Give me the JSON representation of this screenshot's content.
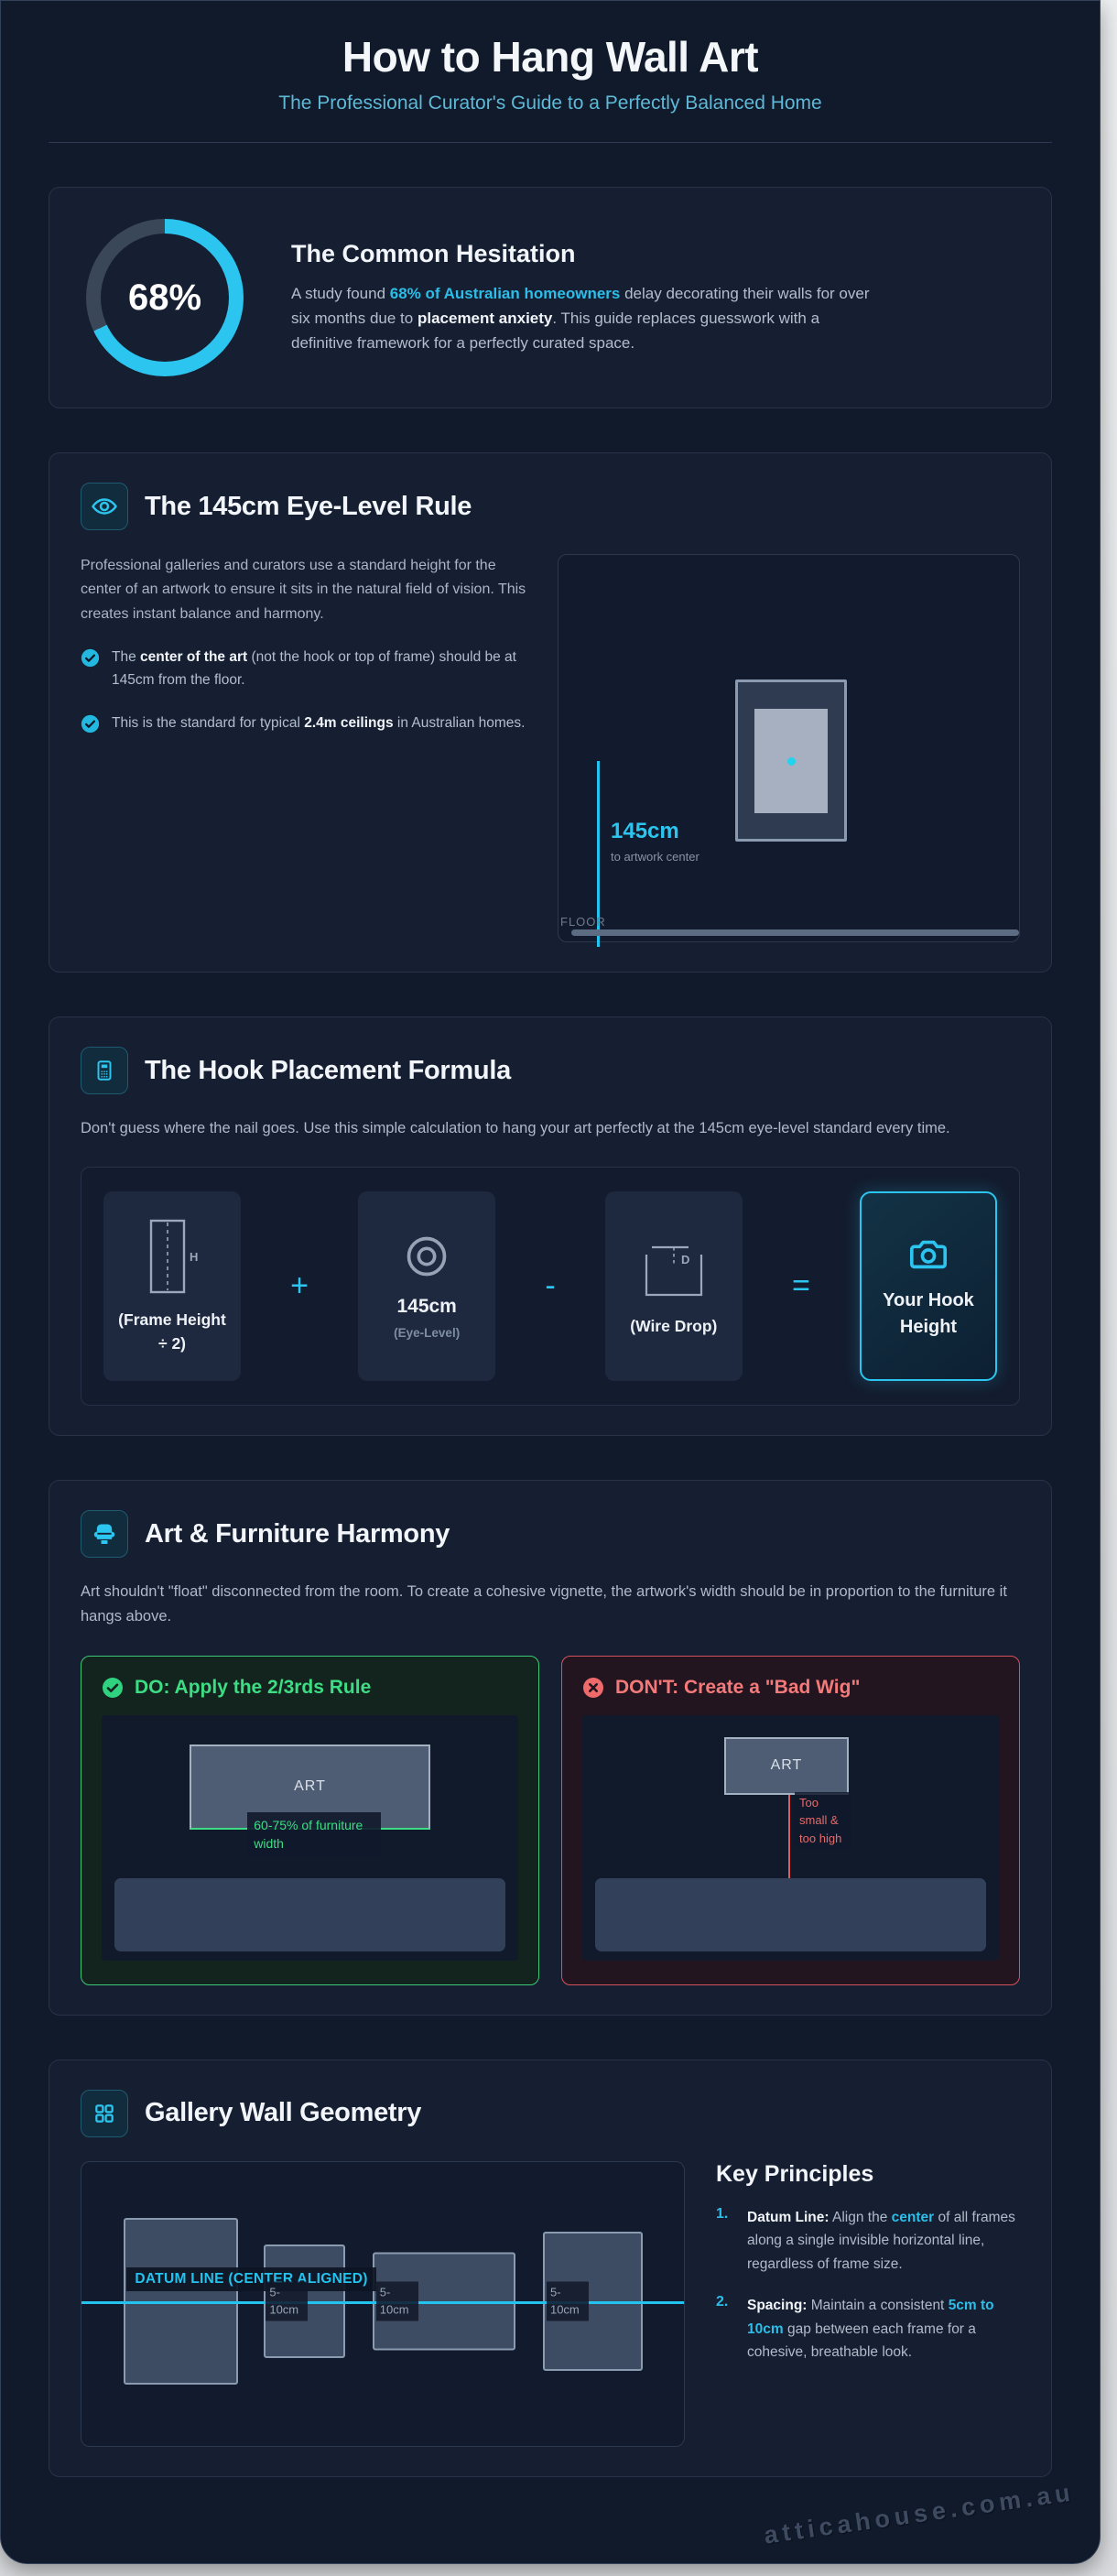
{
  "page": {
    "title": "How to Hang Wall Art",
    "subtitle": "The Professional Curator's Guide to a Perfectly Balanced Home",
    "watermark": "atticahouse.com.au"
  },
  "colors": {
    "accent_cyan": "#2cc5ef",
    "success_green": "#3ddd84",
    "danger_red": "#f47a7a",
    "page_bg": "#101a2b",
    "card_bg": "#161f31"
  },
  "chart_data": {
    "type": "pie",
    "labels": [
      "Homeowners who delay decorating",
      "Other"
    ],
    "values": [
      68,
      32
    ],
    "title": "68% of Australian homeowners delay decorating",
    "center_label": "68%"
  },
  "hesitation": {
    "title": "The Common Hesitation",
    "paragraph": [
      {
        "t": "A study found ",
        "s": "n"
      },
      {
        "t": "68% of Australian homeowners",
        "s": "cb"
      },
      {
        "t": " delay decorating their walls for over six months due to ",
        "s": "n"
      },
      {
        "t": "placement anxiety",
        "s": "wb"
      },
      {
        "t": ". This guide replaces guesswork with a definitive framework for a perfectly curated space.",
        "s": "n"
      }
    ]
  },
  "eye_rule": {
    "title": "The 145cm Eye-Level Rule",
    "paragraph": "Professional galleries and curators use a standard height for the center of an artwork to ensure it sits in the natural field of vision. This creates instant balance and harmony.",
    "bullets": [
      [
        {
          "t": "The ",
          "s": "n"
        },
        {
          "t": "center of the art",
          "s": "wb"
        },
        {
          "t": " (not the hook or top of frame) should be at 145cm from the floor.",
          "s": "n"
        }
      ],
      [
        {
          "t": "This is the standard for typical ",
          "s": "n"
        },
        {
          "t": "2.4m ceilings",
          "s": "wb"
        },
        {
          "t": " in Australian homes.",
          "s": "n"
        }
      ]
    ],
    "diagram": {
      "measure_value": "145cm",
      "measure_caption": "to artwork center",
      "floor_label": "FLOOR"
    }
  },
  "formula": {
    "title": "The Hook Placement Formula",
    "paragraph": "Don't guess where the nail goes. Use this simple calculation to hang your art perfectly at the 145cm eye-level standard every time.",
    "box1": {
      "label": "(Frame Height ÷ 2)",
      "icon_letter": "H"
    },
    "op1": "+",
    "box2": {
      "value": "145cm",
      "sub": "(Eye-Level)"
    },
    "op2": "-",
    "box3": {
      "label": "(Wire Drop)",
      "icon_letter": "D"
    },
    "op3": "=",
    "result": {
      "label": "Your Hook Height"
    }
  },
  "harmony": {
    "title": "Art & Furniture Harmony",
    "paragraph": "Art shouldn't \"float\" disconnected from the room. To create a cohesive vignette, the artwork's width should be in proportion to the furniture it hangs above.",
    "do": {
      "title": "DO: Apply the 2/3rds Rule",
      "art_label": "ART",
      "annotation": "60-75% of furniture width"
    },
    "dont": {
      "title": "DON'T: Create a \"Bad Wig\"",
      "art_label": "ART",
      "annotation": "Too small & too high"
    }
  },
  "gallery": {
    "title": "Gallery Wall Geometry",
    "datum_label": "DATUM LINE (CENTER ALIGNED)",
    "gaps": [
      "5-10cm",
      "5-10cm",
      "5-10cm"
    ],
    "principles": {
      "title": "Key Principles",
      "items": [
        {
          "num": "1.",
          "body": [
            {
              "t": "Datum Line:",
              "s": "wb"
            },
            {
              "t": " Align the ",
              "s": "n"
            },
            {
              "t": "center",
              "s": "cb"
            },
            {
              "t": " of all frames along a single invisible horizontal line, regardless of frame size.",
              "s": "n"
            }
          ]
        },
        {
          "num": "2.",
          "body": [
            {
              "t": "Spacing:",
              "s": "wb"
            },
            {
              "t": " Maintain a consistent ",
              "s": "n"
            },
            {
              "t": "5cm to 10cm",
              "s": "cb"
            },
            {
              "t": " gap between each frame for a cohesive, breathable look.",
              "s": "n"
            }
          ]
        }
      ]
    }
  }
}
